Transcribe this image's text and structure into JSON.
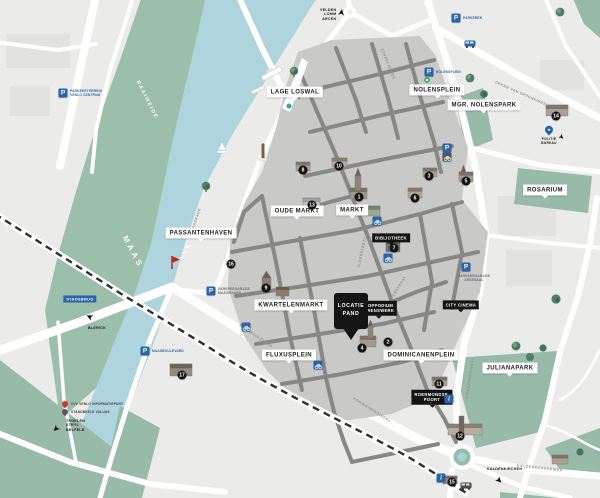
{
  "colors": {
    "water": "#aed4dd",
    "park": "#97bba8",
    "city_base": "#ebebe9",
    "pedestrian_zone": "#c9c9c7",
    "inner_streets": "#878785",
    "road": "#ffffff",
    "railway": "#2f2f2f",
    "accent_blue": "#2b64a8",
    "marker_black": "#141414",
    "red_pin": "#d03a2b"
  },
  "water_labels": {
    "river": "MAAS",
    "meadow": "RAAIWEIDE"
  },
  "squares": [
    {
      "text": "LAGE LOSWAL",
      "x": 295,
      "y": 92
    },
    {
      "text": "NOLENSPLEIN",
      "x": 437,
      "y": 90
    },
    {
      "text": "MGR. NOLENSPARK",
      "x": 484,
      "y": 105
    },
    {
      "text": "OUDE MARKT",
      "x": 297,
      "y": 211
    },
    {
      "text": "MARKT",
      "x": 352,
      "y": 210
    },
    {
      "text": "PASSANTENHAVEN",
      "x": 201,
      "y": 233
    },
    {
      "text": "KWARTELENMARKT",
      "x": 291,
      "y": 305
    },
    {
      "text": "FLUXUSPLEIN",
      "x": 289,
      "y": 355
    },
    {
      "text": "DOMINICANENPLEIN",
      "x": 421,
      "y": 355
    },
    {
      "text": "ROSARIUM",
      "x": 545,
      "y": 190
    },
    {
      "text": "JULIANAPARK",
      "x": 510,
      "y": 368
    }
  ],
  "poi_black": [
    {
      "lines": [
        "BIBLIOTHEEK"
      ],
      "x": 391,
      "y": 238
    },
    {
      "lines": [
        "POPPODIUM",
        "GRENSWERK"
      ],
      "x": 379,
      "y": 308
    },
    {
      "lines": [
        "CITY CINEMA"
      ],
      "x": 461,
      "y": 305
    },
    {
      "lines": [
        "ROERMONDSE-",
        "POORT"
      ],
      "x": 432,
      "y": 397
    }
  ],
  "location_pin": {
    "line1": "LOCATIE",
    "line2": "PAND",
    "x": 351,
    "y": 313
  },
  "bridge_label": {
    "text": "STADSBRUG",
    "x": 80,
    "y": 299
  },
  "police": {
    "line1": "POLITIE",
    "line2": "BUREAU",
    "x": 549,
    "y": 130
  },
  "signs": [
    {
      "lines": [
        "VELDEN",
        "LOMM",
        "ARCEN"
      ],
      "x": 330,
      "y": 15,
      "arrow": "up"
    },
    {
      "lines": [
        "BLERICK"
      ],
      "x": 92,
      "y": 326,
      "arrow": "up-left"
    },
    {
      "lines": [
        "TEGELEN",
        "STEYL",
        "BELFELD"
      ],
      "x": 76,
      "y": 426,
      "arrow": "down-left"
    },
    {
      "lines": [
        "KALDENKIRCHEN"
      ],
      "x": 499,
      "y": 469,
      "arrow": "down-right"
    }
  ],
  "markers": [
    {
      "n": "1",
      "x": 359,
      "y": 197
    },
    {
      "n": "2",
      "x": 388,
      "y": 342
    },
    {
      "n": "3",
      "x": 429,
      "y": 176
    },
    {
      "n": "4",
      "x": 362,
      "y": 348
    },
    {
      "n": "5",
      "x": 466,
      "y": 181
    },
    {
      "n": "6",
      "x": 415,
      "y": 198
    },
    {
      "n": "7",
      "x": 394,
      "y": 248
    },
    {
      "n": "8",
      "x": 303,
      "y": 170
    },
    {
      "n": "9",
      "x": 266,
      "y": 288
    },
    {
      "n": "10",
      "x": 339,
      "y": 166
    },
    {
      "n": "11",
      "x": 439,
      "y": 384
    },
    {
      "n": "12",
      "x": 460,
      "y": 436
    },
    {
      "n": "13",
      "x": 312,
      "y": 205
    },
    {
      "n": "14",
      "x": 556,
      "y": 116
    },
    {
      "n": "15",
      "x": 452,
      "y": 482
    },
    {
      "n": "16",
      "x": 231,
      "y": 264
    },
    {
      "n": "17",
      "x": 182,
      "y": 375
    }
  ],
  "parking": [
    {
      "p": "P",
      "x": 63,
      "y": 93,
      "label_lines": [
        "PARKEERTERREIN",
        "VENLO CENTRUM"
      ]
    },
    {
      "p": "P",
      "x": 429,
      "y": 72,
      "label_lines": [
        "NOLENSPLEIN"
      ]
    },
    {
      "p": "P",
      "x": 447,
      "y": 148,
      "label_lines": []
    },
    {
      "p": "P",
      "x": 211,
      "y": 291,
      "label_lines": [
        "PARKEERGARAGE",
        "MAASWAARD"
      ]
    },
    {
      "p": "P",
      "x": 145,
      "y": 351,
      "label_lines": [
        "MAASBOULEVARD"
      ]
    },
    {
      "p": "P",
      "x": 466,
      "y": 267,
      "label_lines": [
        "PARKEERGARAGE",
        "ARSENAAL"
      ]
    },
    {
      "p": "P",
      "x": 456,
      "y": 18,
      "label_lines": [
        "PARKEREN"
      ]
    }
  ],
  "info_points": [
    {
      "i": "i",
      "x": 449,
      "y": 399
    },
    {
      "i": "i",
      "x": 441,
      "y": 478
    }
  ],
  "bike_points": [
    {
      "x": 377,
      "y": 221
    },
    {
      "x": 388,
      "y": 258
    },
    {
      "x": 246,
      "y": 327
    },
    {
      "x": 318,
      "y": 365
    },
    {
      "x": 447,
      "y": 157
    }
  ],
  "legend": [
    {
      "icon": "red-pin",
      "text": "VVV VENLO INFORMATIEPUNT",
      "x": 64,
      "y": 404
    },
    {
      "icon": "gray-pin",
      "text": "STANDBEELD VALUAS",
      "x": 64,
      "y": 412
    }
  ],
  "street_names": [
    {
      "text": "MAASKADE",
      "x": 196,
      "y": 220,
      "rot": -72
    },
    {
      "text": "VLEESSTRAAT",
      "x": 362,
      "y": 252,
      "rot": -78
    },
    {
      "text": "PEPERSTRAAT",
      "x": 397,
      "y": 290,
      "rot": -58
    },
    {
      "text": "MAASBOULEVARD",
      "x": 256,
      "y": 336,
      "rot": 34
    },
    {
      "text": "KONINGINNESINGEL",
      "x": 372,
      "y": 410,
      "rot": 32
    },
    {
      "text": "PRINSESSESINGEL",
      "x": 470,
      "y": 378,
      "rot": -82
    },
    {
      "text": "DEKEN VAN OPPENSINGEL",
      "x": 522,
      "y": 94,
      "rot": 24
    },
    {
      "text": "KALDENKERKERWEG",
      "x": 540,
      "y": 468,
      "rot": 6
    },
    {
      "text": "STRAELSEWEG",
      "x": 388,
      "y": 64,
      "rot": 68
    }
  ]
}
